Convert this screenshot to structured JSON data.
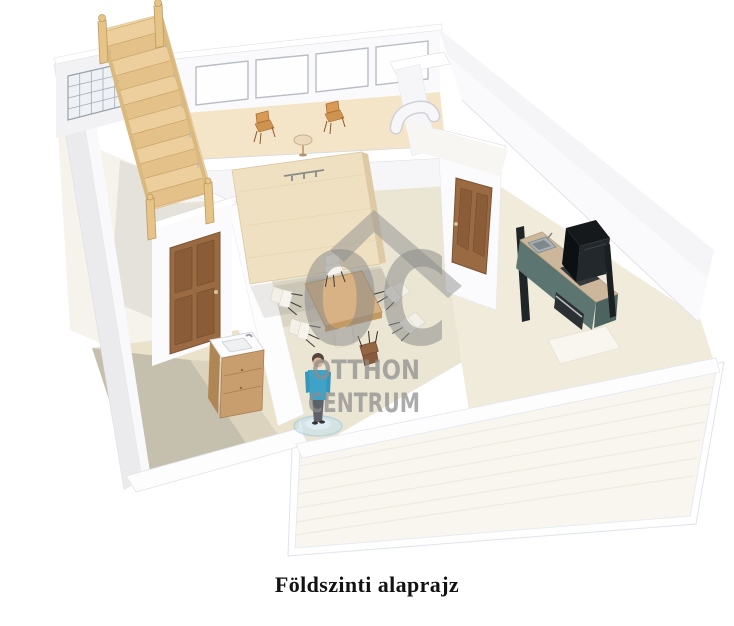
{
  "page": {
    "background": "#ffffff",
    "width": 734,
    "height": 626
  },
  "caption": {
    "text": "Földszinti alaprajz"
  },
  "watermark": {
    "monogram": "OC",
    "line1": "OTTHON",
    "line2": "CENTRUM",
    "color": "#8c8c8c"
  },
  "scene": {
    "kind": "3d-floorplan-render",
    "floor_label": "ground floor",
    "objects": [
      "wooden-staircase-with-railing",
      "glass-block-window",
      "window-row-4-panes",
      "sunroom-wooden-chairs-and-table",
      "ventilation-duct",
      "wardrobe-panel-with-coat-hooks",
      "dining-table-with-chairs",
      "standing-person-figure",
      "bathroom-door",
      "kitchen-door",
      "bathroom-vanity-sink",
      "kitchen-counter-with-sink-cooktop-oven",
      "refrigerator",
      "floor-rug",
      "outdoor-deck-terrace"
    ]
  },
  "palette": {
    "wall": "#fafafc",
    "wall_shade": "#ebebee",
    "floor_living": "#ebe5d3",
    "floor_sunroom": "#f4e5c8",
    "floor_bathroom": "#ebe2cb",
    "deck": "#f8f6ef",
    "stair_wood": "#eccf9c",
    "door_wood": "#9a6b42",
    "wardrobe_wood": "#efe0c2",
    "table_wood": "#d8b284",
    "chair_white": "#f4f1e8",
    "chair_brown": "#8a5a3c",
    "kitchen_cabinet": "#5d7571",
    "counter_top": "#cdb79c",
    "appliance_dark": "#1c2124",
    "person_shirt": "#3fa3c8",
    "watermark_gray": "#8c8c8c"
  }
}
